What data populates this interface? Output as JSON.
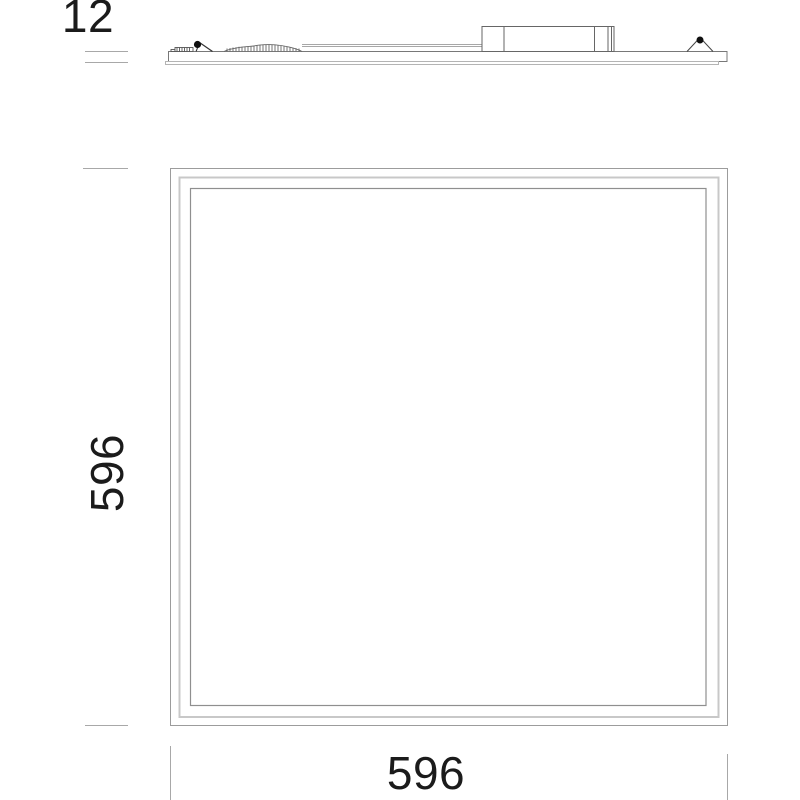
{
  "drawing": {
    "kind": "panel-dimension-drawing",
    "views": {
      "side_profile": "panel edge with spring clips, flex conduit and driver box",
      "front": "square panel with nested frame lines"
    }
  },
  "dimension_labels": {
    "thickness": "12",
    "height": "596",
    "width": "596"
  },
  "style": {
    "background": "#ffffff",
    "text_color": "#1b1b1b",
    "frame_outer_color": "#9c9c9c",
    "frame_middle_color": "#c8c8c8",
    "frame_inner_color": "#8f8f8f",
    "detail_line_color": "#666666",
    "extension_line_color": "#a8a8a8",
    "clip_dot_color": "#101010"
  }
}
